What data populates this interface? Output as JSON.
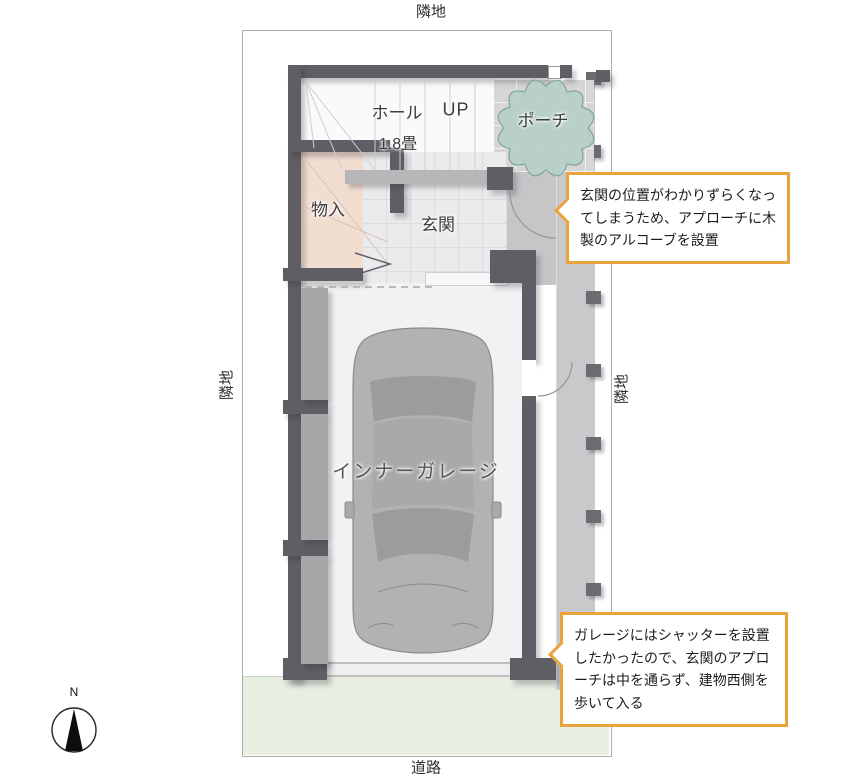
{
  "site": {
    "top_label": "隣地",
    "bottom_label": "道路",
    "left_label": "隣地",
    "right_label": "隣地"
  },
  "compass": {
    "north": "N"
  },
  "rooms": {
    "hall": "ホール",
    "hall_size": "1.8畳",
    "up": "UP",
    "porch": "ポーチ",
    "storage": "物入",
    "entrance": "玄関",
    "garage": "インナーガレージ"
  },
  "callouts": [
    {
      "text": "玄関の位置がわかりずらくなってしまうため、アプローチに木製のアルコーブを設置"
    },
    {
      "text": "ガレージにはシャッターを設置したかったので、玄関のアプローチは中を通らず、建物西側を歩いて入る"
    }
  ],
  "colors": {
    "accent": "#E8A33C",
    "wall": "#5E5E64",
    "tree_green": "#B5CFC4",
    "road_green": "#E7EFE3",
    "storage_peach": "#F2DDD1"
  }
}
